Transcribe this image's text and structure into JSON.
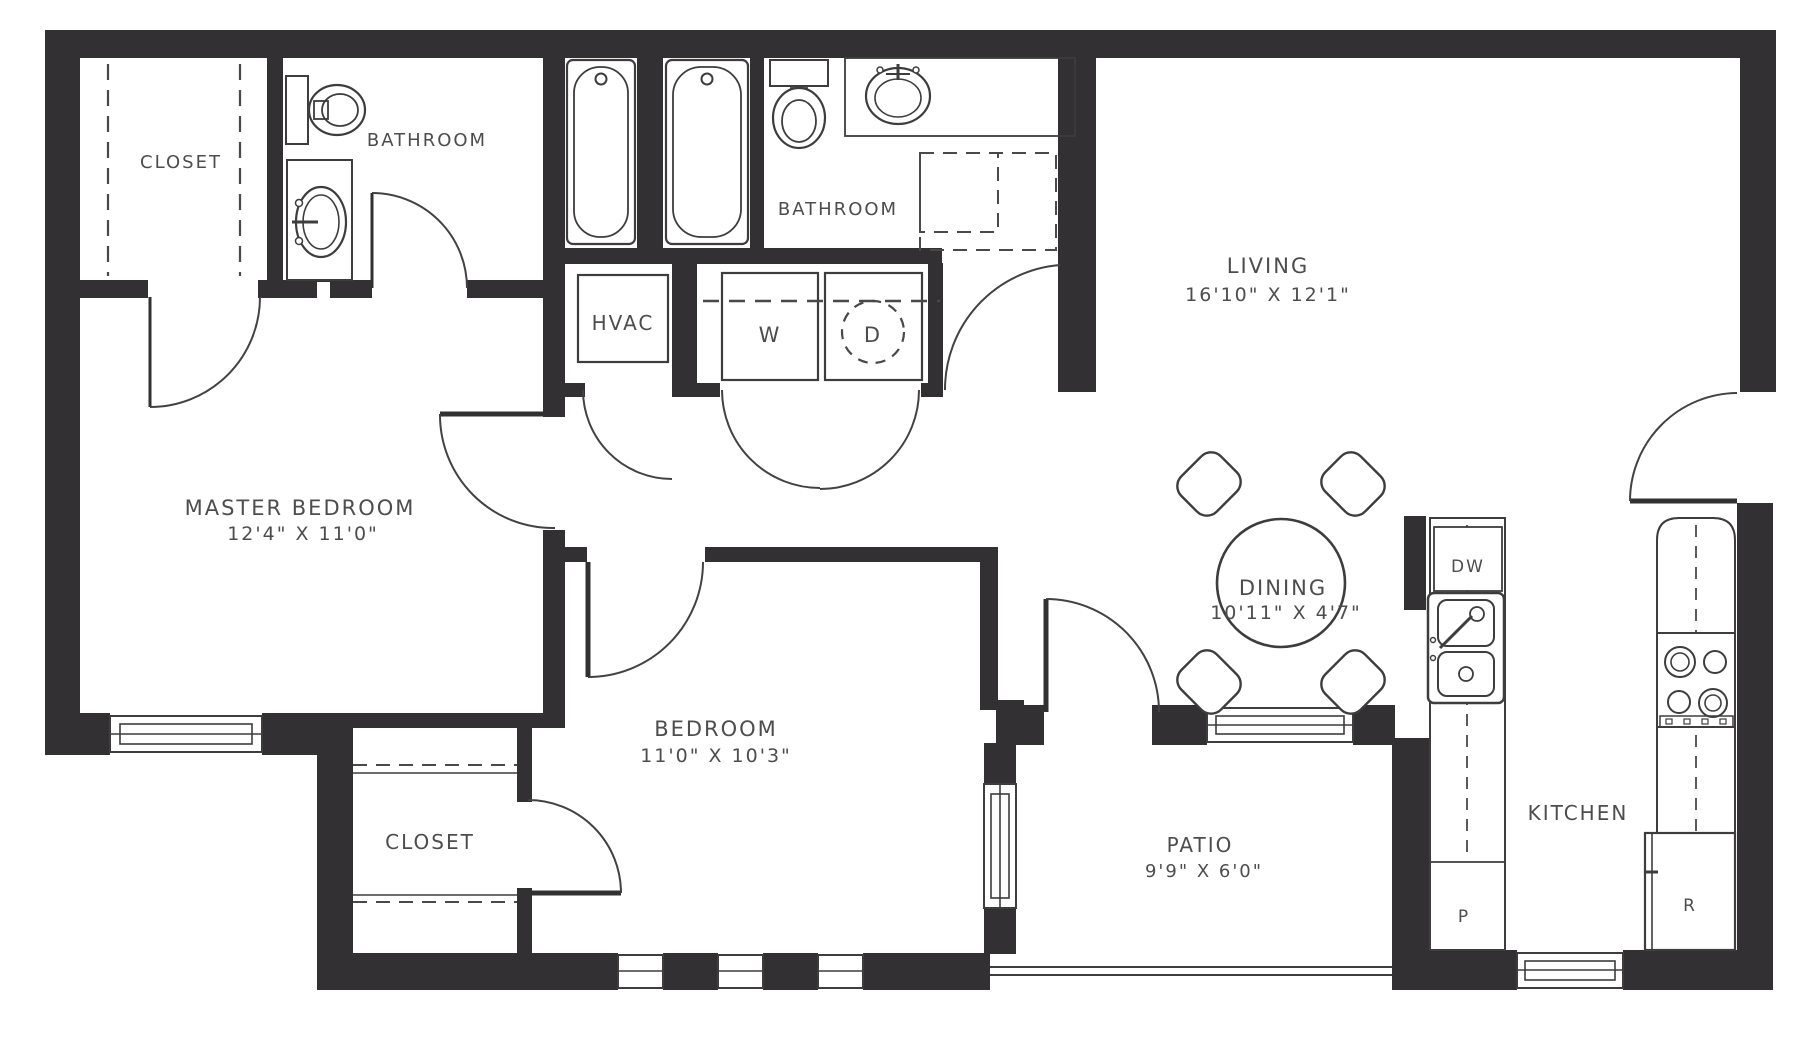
{
  "rooms": {
    "master_closet": {
      "label": "CLOSET"
    },
    "master_bathroom": {
      "label": "BATHROOM"
    },
    "main_bathroom": {
      "label": "BATHROOM"
    },
    "hvac_closet": {
      "label": "HVAC"
    },
    "laundry": {
      "washer_label": "W",
      "dryer_label": "D"
    },
    "living": {
      "label": "LIVING",
      "dimensions": "16'10\" X 12'1\""
    },
    "master_bedroom": {
      "label": "MASTER BEDROOM",
      "dimensions": "12'4\" X 11'0\""
    },
    "bedroom": {
      "label": "BEDROOM",
      "dimensions": "11'0\" X 10'3\""
    },
    "bedroom_closet": {
      "label": "CLOSET"
    },
    "dining": {
      "label": "DINING",
      "dimensions": "10'11\" X 4'7\""
    },
    "patio": {
      "label": "PATIO",
      "dimensions": "9'9\" X 6'0\""
    },
    "kitchen": {
      "label": "KITCHEN",
      "dishwasher_label": "DW",
      "pantry_label": "P",
      "refrigerator_label": "R"
    }
  },
  "fixtures": [
    "bathtub",
    "bathtub",
    "toilet",
    "toilet",
    "vanity-sink",
    "vanity-sink",
    "washer",
    "dryer",
    "hvac-unit",
    "dining-table",
    "dining-chair",
    "kitchen-double-sink",
    "dishwasher",
    "range-cooktop",
    "refrigerator",
    "pantry-cabinet"
  ],
  "colors": {
    "wall": "#323032",
    "line": "#3e3c3d",
    "text": "#4e4c4d",
    "background": "#ffffff"
  }
}
